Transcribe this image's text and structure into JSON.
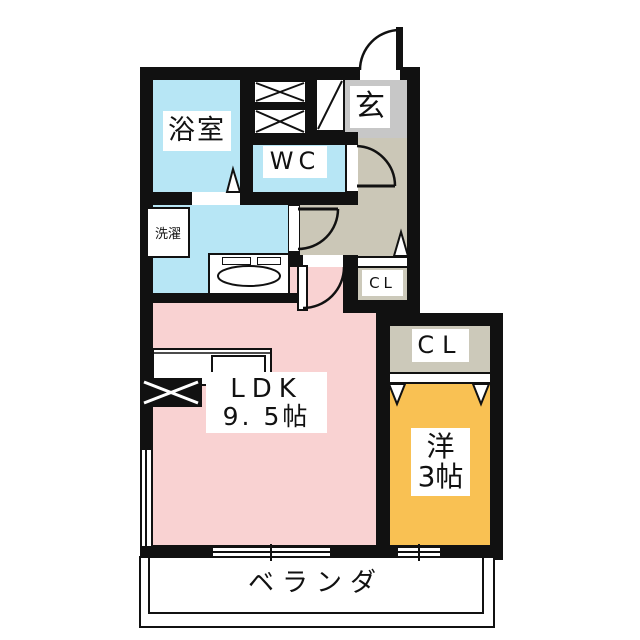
{
  "plan_title": "apartment floor plan",
  "rooms": {
    "bathroom": {
      "label": "浴室"
    },
    "wc": {
      "label": "WC"
    },
    "entrance": {
      "label": "玄"
    },
    "laundry": {
      "label": "洗濯"
    },
    "hall_closet": {
      "label": "CL"
    },
    "bedroom_closet": {
      "label": "CL"
    },
    "ldk": {
      "label": "LDK",
      "size": "9. 5帖"
    },
    "bedroom": {
      "label": "洋",
      "size": "3帖"
    },
    "veranda": {
      "label": "ベランダ"
    }
  },
  "colors": {
    "wall": "#111111",
    "wet_area_floor": "#b7e6f5",
    "ldk_floor": "#f9d2d2",
    "bedroom_floor": "#f9c153",
    "hallway_floor": "#cbc7b7",
    "entrance_floor": "#c7c7c7",
    "closet_floor": "#ccc9ba",
    "background": "#ffffff"
  }
}
